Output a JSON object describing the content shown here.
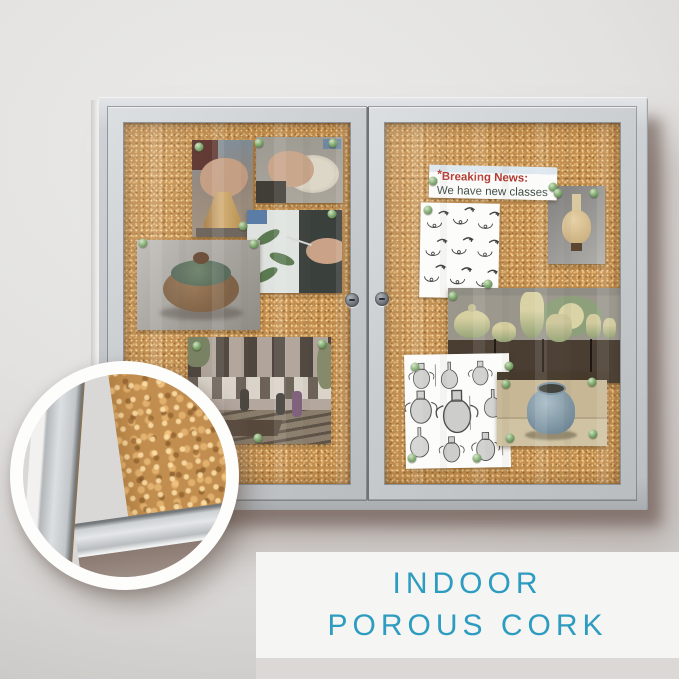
{
  "scene": {
    "wall_color": "#e3e2e0",
    "shadow_color": "#5e4a45",
    "type": "product-photo-enclosed-cork-bulletin-board"
  },
  "caption": {
    "line1": "INDOOR",
    "line2": "POROUS CORK",
    "text_color": "#2e9cc1",
    "panel_color": "#f5f5f3"
  },
  "banner": {
    "mark": "*",
    "title": "Breaking News:",
    "subtitle": "We have new classes",
    "title_color": "#b2372e",
    "subtitle_color": "#3c4a42"
  },
  "board": {
    "frame_color": "#c6cacd",
    "cork_color": "#c28e4f",
    "door_count": 2,
    "lock_count": 2,
    "pin_color": "#6f9a63",
    "pins_left": [
      [
        75,
        24
      ],
      [
        135,
        20
      ],
      [
        209,
        20
      ],
      [
        119,
        103
      ],
      [
        208,
        91
      ],
      [
        130,
        121
      ],
      [
        19,
        120
      ],
      [
        73,
        223
      ],
      [
        198,
        221
      ],
      [
        134,
        315
      ]
    ],
    "pins_right": [
      [
        48,
        58
      ],
      [
        168,
        64
      ],
      [
        43,
        87
      ],
      [
        103,
        161
      ],
      [
        173,
        70
      ],
      [
        209,
        70
      ],
      [
        68,
        173
      ],
      [
        30,
        244
      ],
      [
        124,
        243
      ],
      [
        27,
        335
      ],
      [
        92,
        335
      ],
      [
        121,
        261
      ],
      [
        207,
        259
      ],
      [
        125,
        315
      ],
      [
        208,
        311
      ]
    ]
  },
  "photos": {
    "left_door": [
      {
        "id": "photo-throwing-bell",
        "depicts": "hands shaping clay bell on pottery wheel"
      },
      {
        "id": "photo-wheel-hands",
        "depicts": "hands forming bowl on pottery wheel"
      },
      {
        "id": "photo-lidded-pot",
        "depicts": "ceramic casserole with green lid"
      },
      {
        "id": "photo-glazing",
        "depicts": "hand painting leaf pattern on ceramic"
      },
      {
        "id": "photo-courtyard",
        "depicts": "brick courtyard with people and benches"
      }
    ],
    "right_door": [
      {
        "id": "photo-tan-vase",
        "depicts": "cream vase on gray background"
      },
      {
        "id": "sheet-pottery-diagrams",
        "depicts": "grid of vessel profile sketches"
      },
      {
        "id": "photo-green-pottery",
        "depicts": "green drip-glaze tea set on wooden chest"
      },
      {
        "id": "sheet-amphora-etchings",
        "depicts": "black and white amphora drawings"
      },
      {
        "id": "photo-blue-pot",
        "depicts": "blue-gray round pot on beige table"
      }
    ]
  },
  "magnifier": {
    "shows": "cork-texture-closeup-with-frame-corner"
  }
}
